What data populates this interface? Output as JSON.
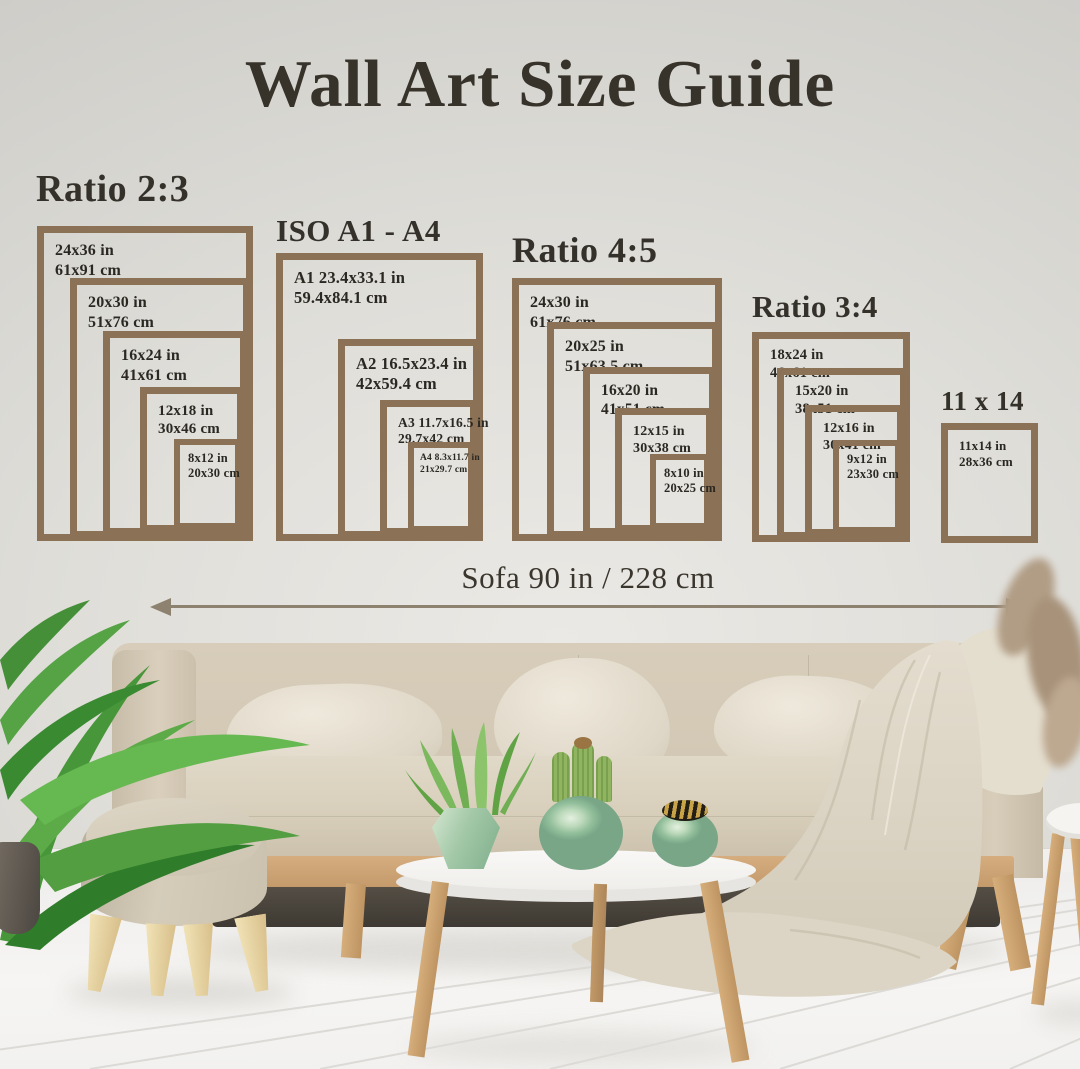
{
  "title": "Wall Art Size Guide",
  "sofa": {
    "label": "Sofa 90 in / 228 cm"
  },
  "colors": {
    "frame_brown": "#8b7257",
    "text_dark": "#2b2822",
    "arrow": "#8d8170",
    "wall": "#dfded9",
    "floor": "#f4f3f1",
    "sofa_beige": "#d4c9b6",
    "vase_celadon": "#9cc3a0",
    "wood": "#cda575"
  },
  "groups": [
    {
      "title": "Ratio 2:3",
      "frames": [
        {
          "in": "24x36 in",
          "cm": "61x91 cm"
        },
        {
          "in": "20x30 in",
          "cm": "51x76 cm"
        },
        {
          "in": "16x24 in",
          "cm": "41x61 cm"
        },
        {
          "in": "12x18 in",
          "cm": "30x46 cm"
        },
        {
          "in": "8x12 in",
          "cm": "20x30 cm"
        }
      ]
    },
    {
      "title": "ISO A1 - A4",
      "frames": [
        {
          "in": "A1 23.4x33.1 in",
          "cm": "59.4x84.1 cm"
        },
        {
          "in": "A2 16.5x23.4 in",
          "cm": "42x59.4 cm"
        },
        {
          "in": "A3 11.7x16.5 in",
          "cm": "29.7x42 cm"
        },
        {
          "in": "A4 8.3x11.7 in",
          "cm": "21x29.7 cm"
        }
      ]
    },
    {
      "title": "Ratio 4:5",
      "frames": [
        {
          "in": "24x30 in",
          "cm": "61x76 cm"
        },
        {
          "in": "20x25 in",
          "cm": "51x63.5 cm"
        },
        {
          "in": "16x20 in",
          "cm": "41x51 cm"
        },
        {
          "in": "12x15 in",
          "cm": "30x38 cm"
        },
        {
          "in": "8x10 in",
          "cm": "20x25 cm"
        }
      ]
    },
    {
      "title": "Ratio 3:4",
      "frames": [
        {
          "in": "18x24 in",
          "cm": "46x61 cm"
        },
        {
          "in": "15x20 in",
          "cm": "38x51 cm"
        },
        {
          "in": "12x16 in",
          "cm": "30x41 cm"
        },
        {
          "in": "9x12 in",
          "cm": "23x30 cm"
        }
      ]
    },
    {
      "title": "11 x 14",
      "frames": [
        {
          "in": "11x14 in",
          "cm": "28x36 cm"
        }
      ]
    }
  ]
}
